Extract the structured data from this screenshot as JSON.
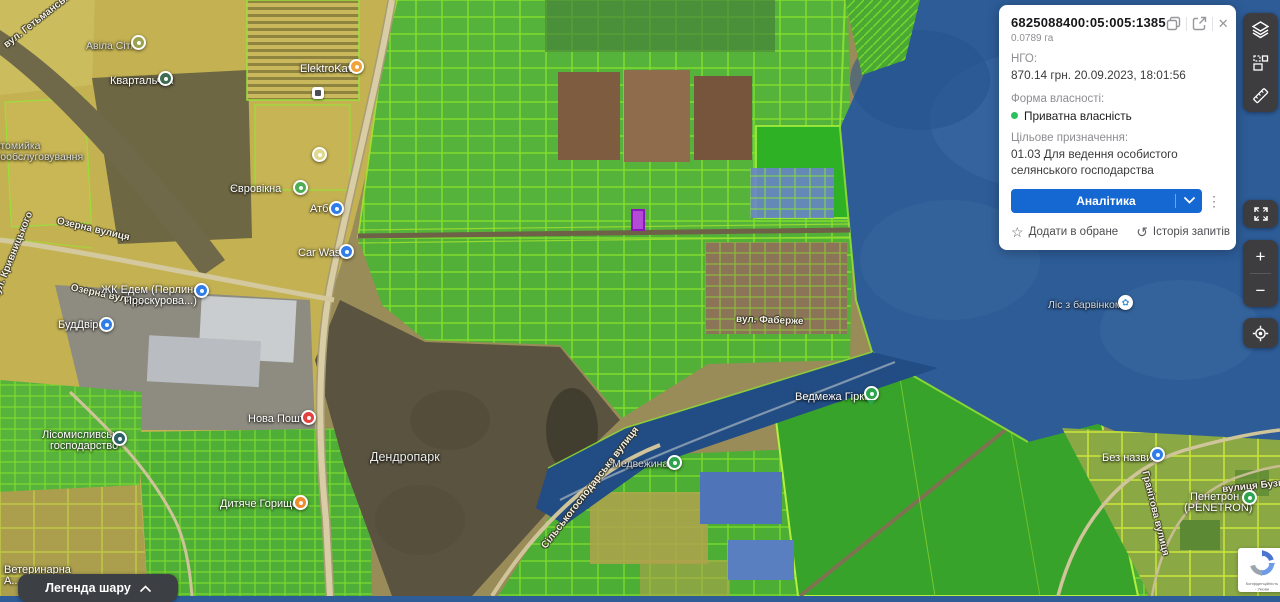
{
  "panel": {
    "title": "6825088400:05:005:1385",
    "area": "0.0789 га",
    "ngo_label": "НГО:",
    "ngo_value": "870.14 грн. 20.09.2023, 18:01:56",
    "ownership_label": "Форма власності:",
    "ownership_value": "Приватна власність",
    "ownership_dot_color": "#2dbe60",
    "purpose_label": "Цільове призначення:",
    "purpose_value": "01.03 Для ведення особистого селянського господарства",
    "analytics_button": "Аналітика",
    "accent_color": "#1567d2",
    "kebab": "⋮",
    "close": "✕",
    "add_favorite": "Додати в обране",
    "favorite_icon": "☆",
    "history": "Історія запитів",
    "history_icon": "↺"
  },
  "controls": {
    "zoom_in": "+",
    "zoom_out": "−"
  },
  "legend": {
    "label": "Легенда шару"
  },
  "recaptcha": {
    "line1": "Конфіденційність",
    "line2": "- Умови"
  },
  "map": {
    "labels": {
      "hetmanska": "вул. Гетьманська",
      "avila": "Авіла Сіті",
      "kvartalchyk": "Квартальчик",
      "elektrokava": "ElektroKava",
      "carwash_self_1": "Автомийка",
      "carwash_self_2": "самообслуговування",
      "eurovikna": "Євровікна",
      "atb": "Атб",
      "car_wash": "Car Wash",
      "ozerna": "Озерна вулиця",
      "kryvnytskoho": "вул. Кривницького",
      "zhk_edem_1": "ЖК Едем (Перлина",
      "zhk_edem_2": "Проскурова...)",
      "buddvir": "БудДвір",
      "lisomyslyvske_1": "Лісомисливське",
      "lisomyslyvske_2": "господарство",
      "nova_poshta": "Нова Пошта",
      "dytiache": "Дитяче Горище",
      "dendropark": "Дендропарк",
      "faberzhe": "вул. Фаберже",
      "vedmezha": "Ведмежа Гірка",
      "lis_barvinkom": "Ліс з барвінком",
      "medvezhyna": "Медвежина",
      "silskohospodarska": "Сільськогосподарська вулиця",
      "bez_nazvy": "Без назви",
      "penetron_1": "Пенетрон",
      "penetron_2": "(PENETRON)",
      "hranitova": "Гранітова вулиця",
      "buzkova": "вулиця Бузкова",
      "veterynarna_1": "Ветеринарна",
      "veterynarna_2": "А..."
    }
  }
}
